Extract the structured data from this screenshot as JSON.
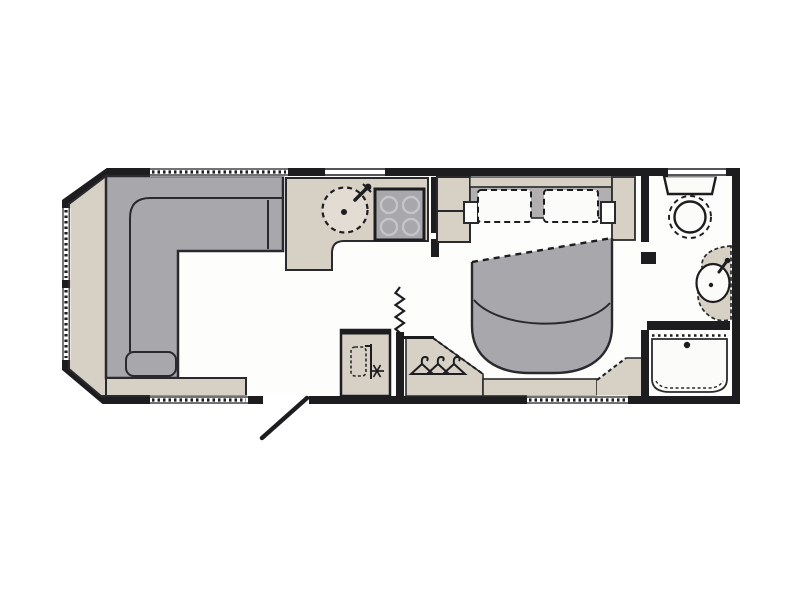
{
  "title": "Caravan floor plan",
  "colors": {
    "page": "#ffffff",
    "floor": "#fdfdfb",
    "wall": "#1d1d20",
    "outline": "#2a2a2e",
    "beige": "#d7d0c5",
    "gray": "#a7a7ac",
    "headboard": "#b2afb1",
    "fixture": "#fbfbfa",
    "burner": "#c4c4c9"
  },
  "floorplan": {
    "type": "touring caravan layout diagram",
    "areas": [
      {
        "id": "lounge",
        "name": "front lounge",
        "furniture": [
          "L-shaped sofa",
          "front parcel shelf",
          "side shelf"
        ]
      },
      {
        "id": "kitchen",
        "name": "kitchen",
        "furniture": [
          "L-shaped worktop",
          "round sink with tap",
          "four-burner hob"
        ]
      },
      {
        "id": "midship",
        "name": "mid corridor",
        "furniture": [
          "chest of drawers",
          "entrance door",
          "fridge cabinet",
          "concertina divider",
          "wardrobe with clothes hangers"
        ]
      },
      {
        "id": "bedroom",
        "name": "island-bed bedroom",
        "furniture": [
          "double bed",
          "two pillows",
          "duvet",
          "bedside shelves",
          "foot-of-bed platform"
        ]
      },
      {
        "id": "washroom",
        "name": "end washroom",
        "furniture": [
          "toilet",
          "wash basin with tap",
          "vanity counter",
          "shower tray with drain",
          "shower screen"
        ]
      }
    ],
    "windows": [
      "front offside upper",
      "front offside lower",
      "top lounge",
      "top kitchen",
      "top washroom",
      "bottom lounge",
      "bottom bedroom"
    ]
  }
}
